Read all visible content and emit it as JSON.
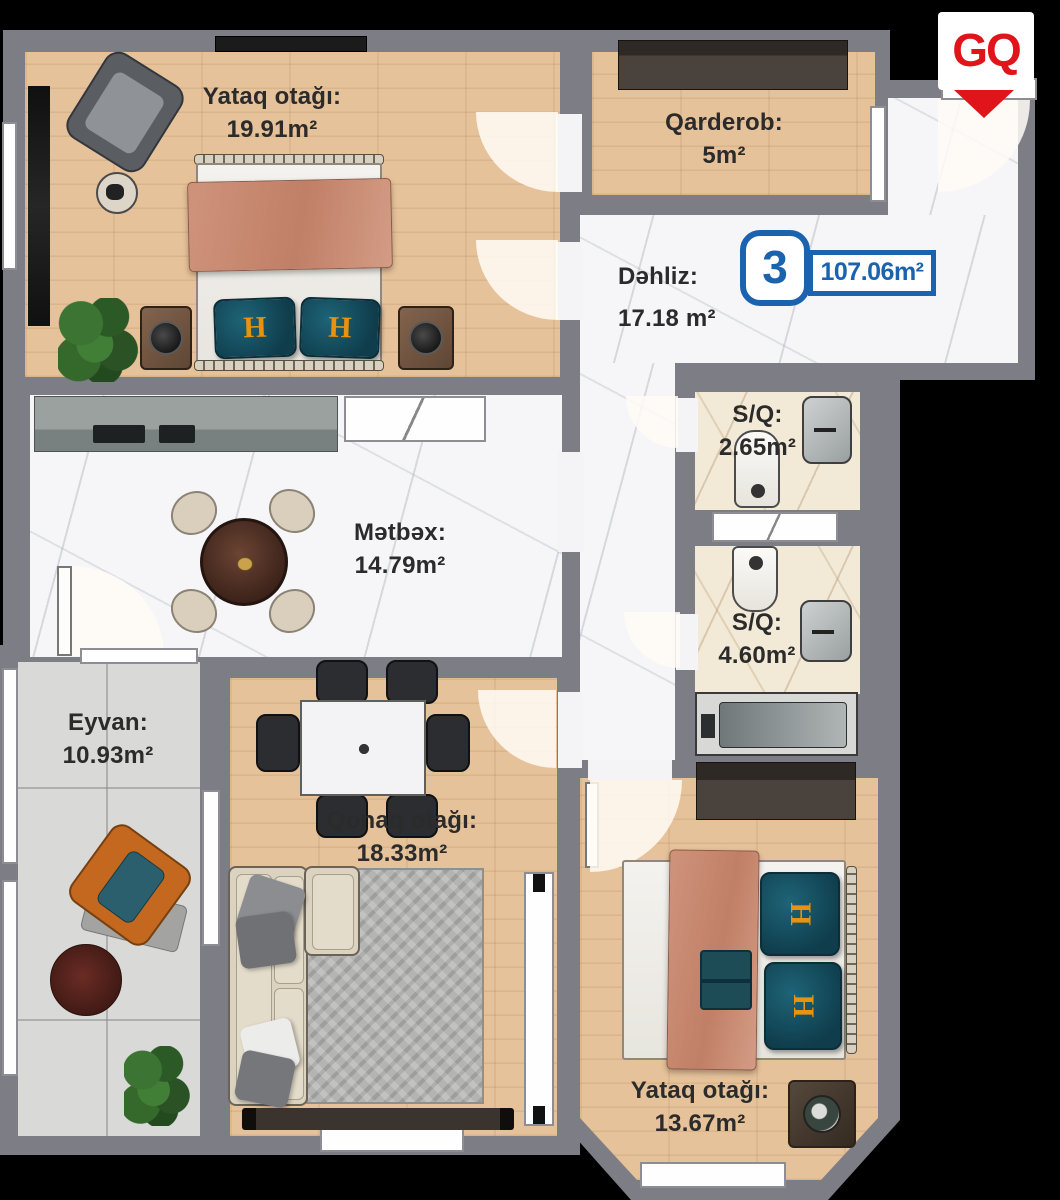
{
  "logo": {
    "text": "GQ"
  },
  "unit_badge": {
    "number": "3",
    "total_area": "107.06m²"
  },
  "rooms": [
    {
      "id": "bedroom-1",
      "label": "Yataq otağı:",
      "area": "19.91m²"
    },
    {
      "id": "wardrobe",
      "label": "Qarderob:",
      "area": "5m²"
    },
    {
      "id": "hallway",
      "label": "Dəhliz:",
      "area": "17.18 m²"
    },
    {
      "id": "bathroom-small",
      "label": "S/Q:",
      "area": "2.65m²"
    },
    {
      "id": "bathroom-large",
      "label": "S/Q:",
      "area": "4.60m²"
    },
    {
      "id": "kitchen",
      "label": "Mətbəx:",
      "area": "14.79m²"
    },
    {
      "id": "balcony",
      "label": "Eyvan:",
      "area": "10.93m²"
    },
    {
      "id": "living-room",
      "label": "Qonaq otağı:",
      "area": "18.33m²"
    },
    {
      "id": "bedroom-2",
      "label": "Yataq otağı:",
      "area": "13.67m²"
    }
  ],
  "decor": {
    "pillow_monogram": "H"
  },
  "colors": {
    "accent_blue": "#1b63ae",
    "logo_red": "#e0151b",
    "wall_gray": "#7d7d85",
    "wood_floor": "#e6c29a",
    "marble_floor": "#f6f6f8",
    "bath_tile": "#f3e9d7",
    "balcony_tile": "#d9d9d7",
    "label_text": "#2b2b2b"
  }
}
